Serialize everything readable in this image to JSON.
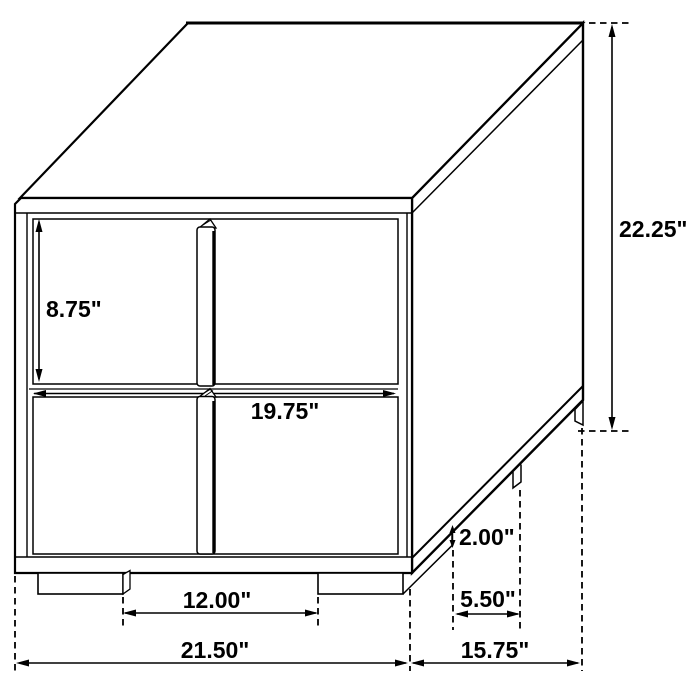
{
  "page": {
    "background": "#ffffff",
    "line_color": "#000000",
    "text_color": "#000000"
  },
  "diagram": {
    "subject": "2-drawer nightstand isometric dimension drawing",
    "unit": "inches",
    "labels": {
      "overall_height": "22.25\"",
      "drawer_opening_height": "8.75\"",
      "drawer_width": "19.75\"",
      "leg_height": "2.00\"",
      "side_leg_spacing": "5.50\"",
      "front_leg_spacing": "12.00\"",
      "overall_width": "21.50\"",
      "overall_depth": "15.75\""
    }
  }
}
